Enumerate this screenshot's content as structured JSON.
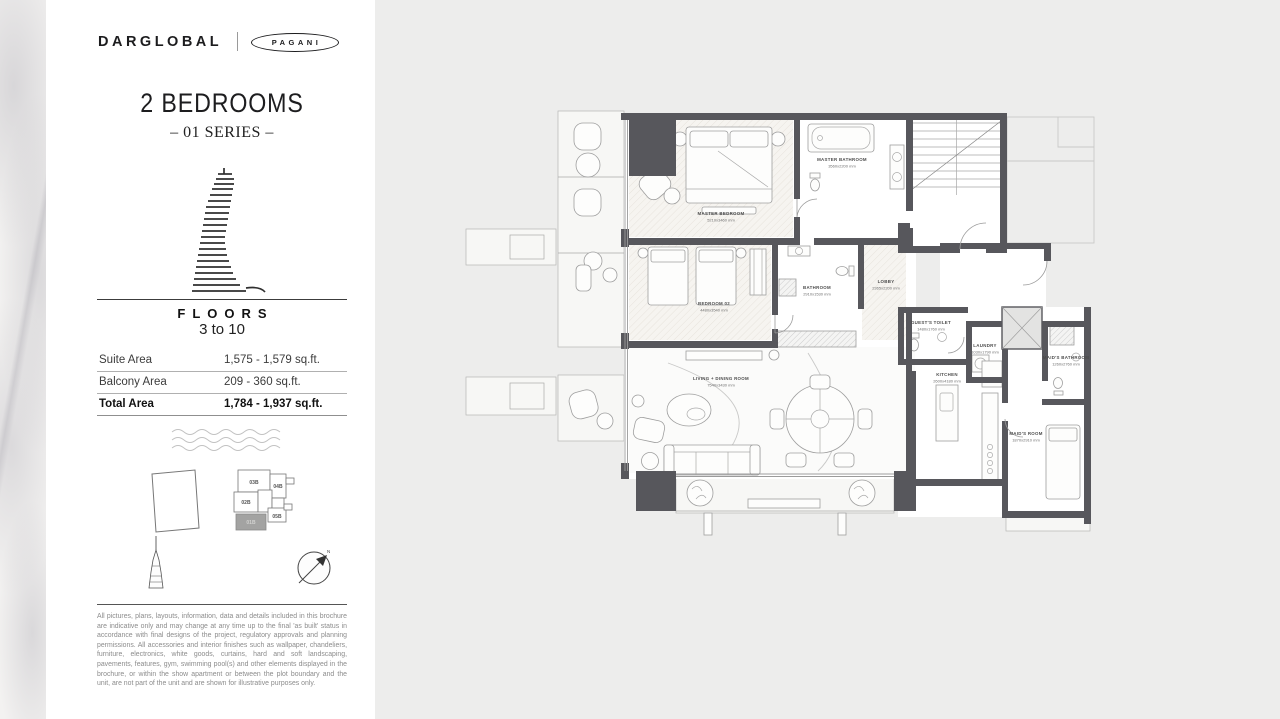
{
  "brand": {
    "primary": "DARGLOBAL",
    "secondary": "PAGANI"
  },
  "header": {
    "title": "2 BEDROOMS",
    "series": "– 01 SERIES –"
  },
  "floors": {
    "label": "FLOORS",
    "range": "3 to 10"
  },
  "area_table": {
    "rows": [
      {
        "label": "Suite Area",
        "value": "1,575 - 1,579 sq.ft."
      },
      {
        "label": "Balcony Area",
        "value": "209 - 360 sq.ft."
      },
      {
        "label": "Total Area",
        "value": "1,784 - 1,937 sq.ft."
      }
    ]
  },
  "key_plan": {
    "units": [
      "03B",
      "04B",
      "02B",
      "05B"
    ],
    "highlighted": "01B"
  },
  "compass": {
    "north": "N"
  },
  "floor_plan": {
    "rooms": [
      {
        "name": "MASTER BEDROOM",
        "dims": "5210x3460 mm"
      },
      {
        "name": "MASTER BATHROOM",
        "dims": "3560x2200 mm"
      },
      {
        "name": "BEDROOM 02",
        "dims": "4480x3540 mm"
      },
      {
        "name": "BATHROOM",
        "dims": "2910x1530 mm"
      },
      {
        "name": "LOBBY",
        "dims": "2365x2200 mm"
      },
      {
        "name": "GUEST'S TOILET",
        "dims": "1480x1760 mm"
      },
      {
        "name": "LAUNDRY",
        "dims": "1030x1790 mm"
      },
      {
        "name": "KITCHEN",
        "dims": "2600x4180 mm"
      },
      {
        "name": "MAID'S BATHROOM",
        "dims": "1260x2760 mm"
      },
      {
        "name": "MAID'S ROOM",
        "dims": "1870x2910 mm"
      },
      {
        "name": "LIVING + DINING ROOM",
        "dims": "7540x3430 mm"
      }
    ]
  },
  "disclaimer": "All pictures, plans, layouts, information, data and details included in this brochure are indicative only and may change at any time up to the final 'as built' status in accordance with final designs of the project, regulatory approvals and planning permissions. All accessories and interior finishes such as wallpaper, chandeliers, furniture, electronics, white goods, curtains, hard and soft landscaping, pavements, features, gym, swimming pool(s) and other elements displayed in the brochure, or within the show apartment or between the plot boundary and the unit, are not part of the unit and are shown for illustrative purposes only.",
  "colors": {
    "wall": "#57575c",
    "background": "#ededec",
    "ink": "#1c1c1e"
  }
}
